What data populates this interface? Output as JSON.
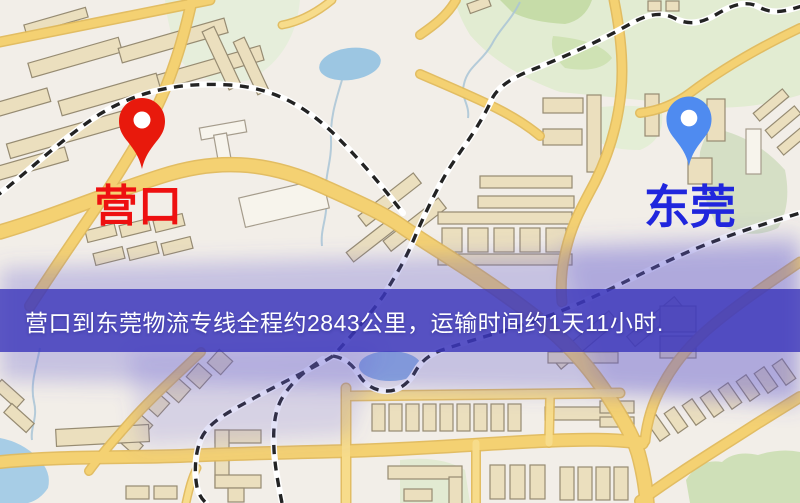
{
  "window": {
    "width": 800,
    "height": 503
  },
  "map": {
    "origin": {
      "label": "营口",
      "pin_color": "#e8190c",
      "label_color": "#ee1010"
    },
    "destination": {
      "label": "东莞",
      "pin_color": "#4f8bf0",
      "label_color": "#2026dd"
    },
    "route": {
      "from": "营口",
      "to": "东莞",
      "distance_km": 2843,
      "duration": "1天11小时"
    },
    "banner": {
      "text": "营口到东莞物流专线全程约2843公里，运输时间约1天11小时.",
      "bg_color": "rgba(57,53,186,0.80)",
      "text_color": "#ffffff"
    },
    "colors": {
      "background": "#f2eee8",
      "road": "#f4d172",
      "road_casing": "#e0b95c",
      "building": "#ebdfbe",
      "building_outline": "#968b72",
      "green": "#dfeacd",
      "water": "#9fc7e0",
      "railway": "#232323",
      "tint_overlay": "#5f58d0"
    }
  }
}
